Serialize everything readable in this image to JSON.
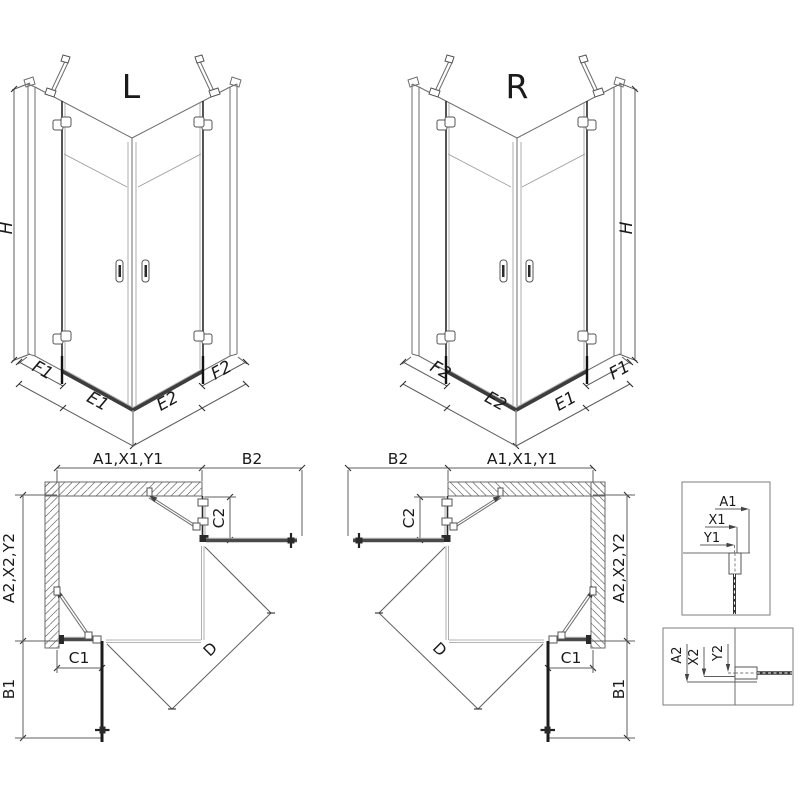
{
  "iso_left": {
    "variant_label": "L",
    "height_label": "H",
    "bottom_segments": [
      "F1",
      "E1",
      "E2",
      "F2"
    ]
  },
  "iso_right": {
    "variant_label": "R",
    "height_label": "H",
    "bottom_segments": [
      "F2",
      "E2",
      "E1",
      "F1"
    ]
  },
  "plan_left": {
    "width_total_label": "A1,X1,Y1",
    "door_return_label": "B2",
    "depth_total_label": "A2,X2,Y2",
    "return_panel_label": "C2",
    "fixed_panel_label": "C1",
    "door_panel_label": "B1",
    "entry_diagonal_label": "D"
  },
  "plan_right": {
    "width_total_label": "A1,X1,Y1",
    "door_return_label": "B2",
    "depth_total_label": "A2,X2,Y2",
    "return_panel_label": "C2",
    "fixed_panel_label": "C1",
    "door_panel_label": "B1",
    "entry_diagonal_label": "D"
  },
  "detail_glass_vertical": {
    "outer": "A1",
    "profile": "X1",
    "glass": "Y1"
  },
  "detail_glass_horizontal": {
    "outer": "A2",
    "profile": "X2",
    "glass": "Y2"
  },
  "colors": {
    "line": "#6e6e6e",
    "dimension": "#5f5f5f",
    "glass_dark": "#1c1c1c",
    "glass_mid": "#4a4a4a",
    "threshold": "#3d3d3d",
    "text": "#1a1a1a"
  }
}
